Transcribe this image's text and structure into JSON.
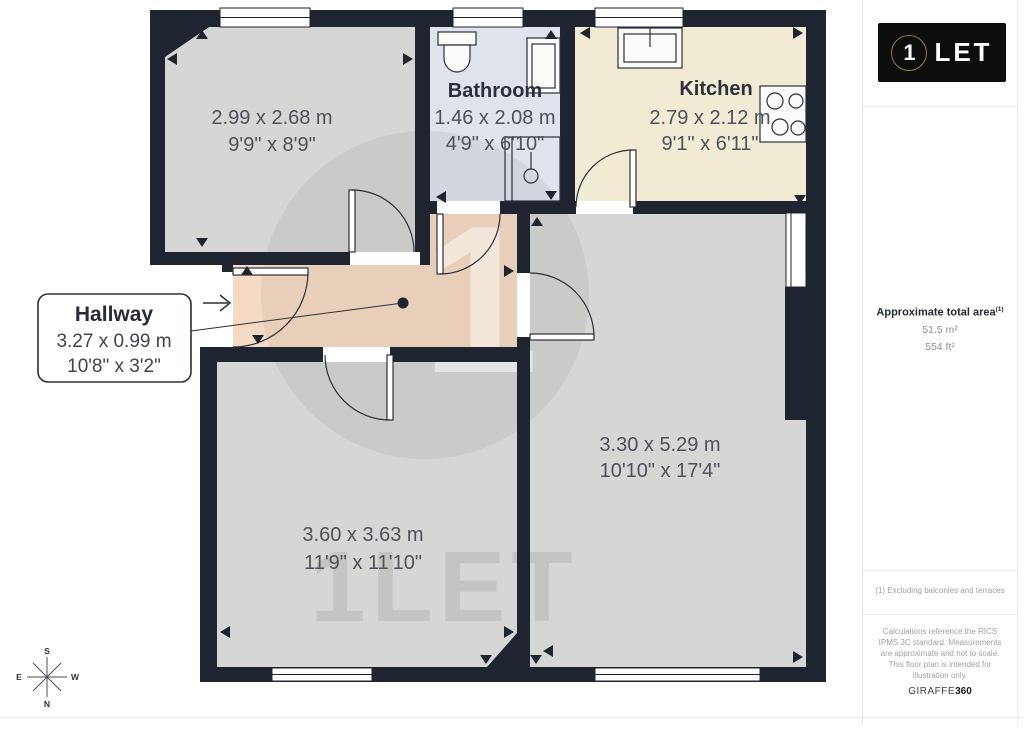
{
  "branding": {
    "logo_digit": "1",
    "logo_word": "LET",
    "watermark_digit": "1",
    "watermark_text": "1LET",
    "footer_brand": "GIRAFFE",
    "footer_brand_suffix": "360"
  },
  "sidebar": {
    "area_title": "Approximate total area",
    "area_footnote_marker": "(1)",
    "area_metric": "51.5 m²",
    "area_imperial": "554 ft²",
    "footnote": "(1) Excluding balconies and terraces",
    "disclaimer": "Calculations reference the RICS IPMS 3C standard. Measurements are approximate and not to scale. This floor plan is intended for illustration only."
  },
  "plan": {
    "rooms": [
      {
        "id": "room-top-left",
        "label": "",
        "dims_m": "2.99 x 2.68 m",
        "dims_ft": "9'9\" x 8'9\""
      },
      {
        "id": "bathroom",
        "label": "Bathroom",
        "dims_m": "1.46 x 2.08 m",
        "dims_ft": "4'9\" x 6'10\""
      },
      {
        "id": "kitchen",
        "label": "Kitchen",
        "dims_m": "2.79 x 2.12 m",
        "dims_ft": "9'1\" x 6'11\""
      },
      {
        "id": "hallway",
        "label": "Hallway",
        "dims_m": "3.27 x 0.99 m",
        "dims_ft": "10'8\" x 3'2\""
      },
      {
        "id": "room-bottom-left",
        "label": "",
        "dims_m": "3.60 x 3.63 m",
        "dims_ft": "11'9\" x 11'10\""
      },
      {
        "id": "room-right",
        "label": "",
        "dims_m": "3.30 x 5.29 m",
        "dims_ft": "10'10\" x 17'4\""
      }
    ]
  },
  "compass": {
    "north": "N",
    "south": "S",
    "east": "E",
    "west": "W"
  },
  "colors": {
    "wall": "#1e2531",
    "floor": "#d6d6d4",
    "bathroom_floor": "#e0e3ec",
    "kitchen_floor": "#f2ebd3",
    "hallway_floor": "#f5dbc5",
    "logo_bg": "#0c0d0c",
    "logo_ring": "#8f7d45"
  }
}
